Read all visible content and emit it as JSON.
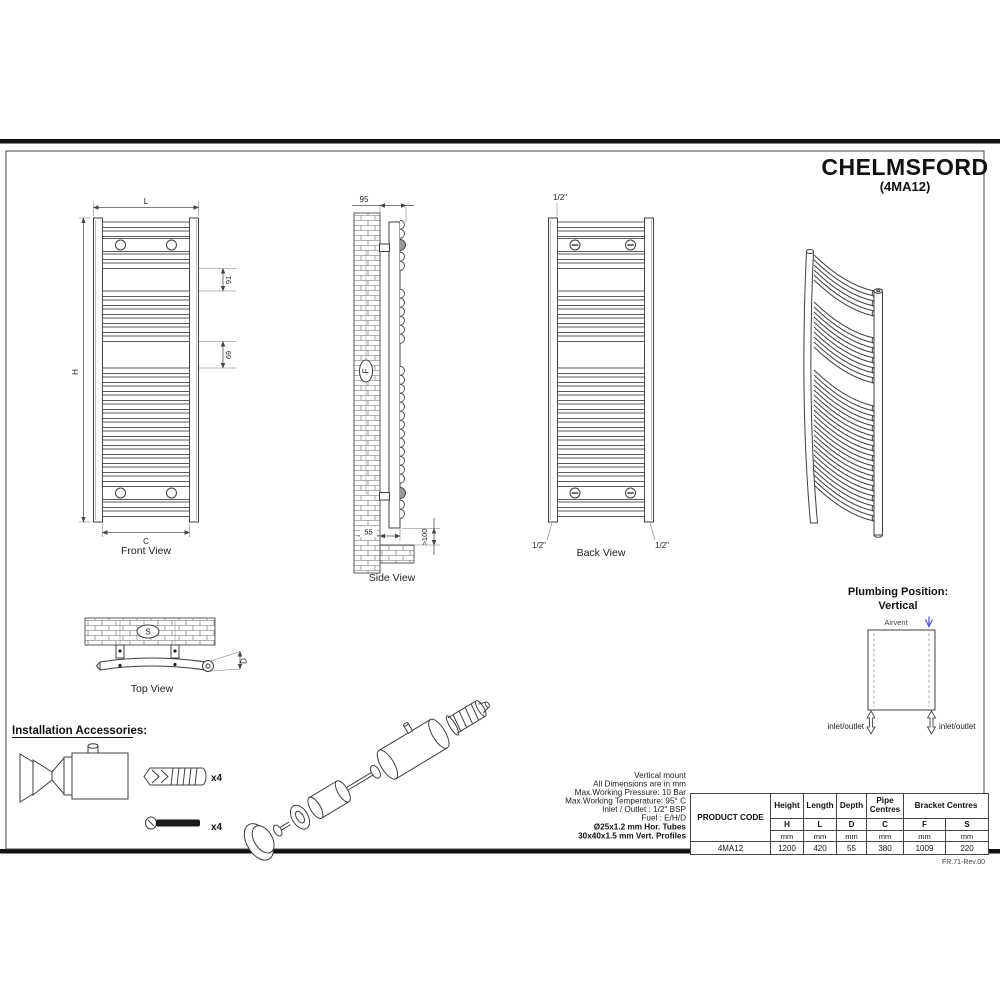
{
  "title": {
    "name": "CHELMSFORD",
    "code": "(4MA12)"
  },
  "views": {
    "front": {
      "caption": "Front View",
      "width_label": "L",
      "height_label": "H",
      "centres_label": "C",
      "gap1": "91",
      "gap2": "69"
    },
    "side": {
      "caption": "Side View",
      "total_depth": "95",
      "wall_gap": "55",
      "floor_clearance": ">100",
      "bracket_label": "F"
    },
    "back": {
      "caption": "Back View",
      "conn_top": "1/2\"",
      "conn_bottom_left": "1/2\"",
      "conn_bottom_right": "1/2\""
    },
    "top": {
      "caption": "Top View",
      "bracket_label": "S",
      "depth_label": "D"
    }
  },
  "plumbing": {
    "title1": "Plumbing Position:",
    "title2": "Vertical",
    "airvent": "Airvent",
    "inlet_left": "inlet/outlet",
    "inlet_right": "inlet/outlet"
  },
  "accessories": {
    "heading": "Installation Accessories:",
    "plug_qty": "x4",
    "screw_qty": "x4"
  },
  "specs": [
    "Vertical mount",
    "All Dimensions are in mm",
    "Max.Working Pressure: 10 Bar",
    "Max.Working Temperature: 95° C",
    "Inlet / Outlet : 1/2\" BSP",
    "Fuel : E/H/D",
    "Ø25x1.2 mm Hor. Tubes",
    "30x40x1.5 mm Vert. Profiles"
  ],
  "table": {
    "product_code": "PRODUCT CODE",
    "groups": [
      "Height",
      "Length",
      "Depth",
      "Pipe Centres",
      "Bracket Centres"
    ],
    "letters": [
      "H",
      "L",
      "D",
      "C",
      "F",
      "S"
    ],
    "units": [
      "mm",
      "mm",
      "mm",
      "mm",
      "mm",
      "mm"
    ],
    "code_value": "4MA12",
    "values": [
      "1200",
      "420",
      "55",
      "380",
      "1009",
      "220"
    ]
  },
  "revision": "FR.71-Rev.00",
  "colors": {
    "line": "#3f3f3f",
    "accent_blue": "#5a5ad0"
  }
}
